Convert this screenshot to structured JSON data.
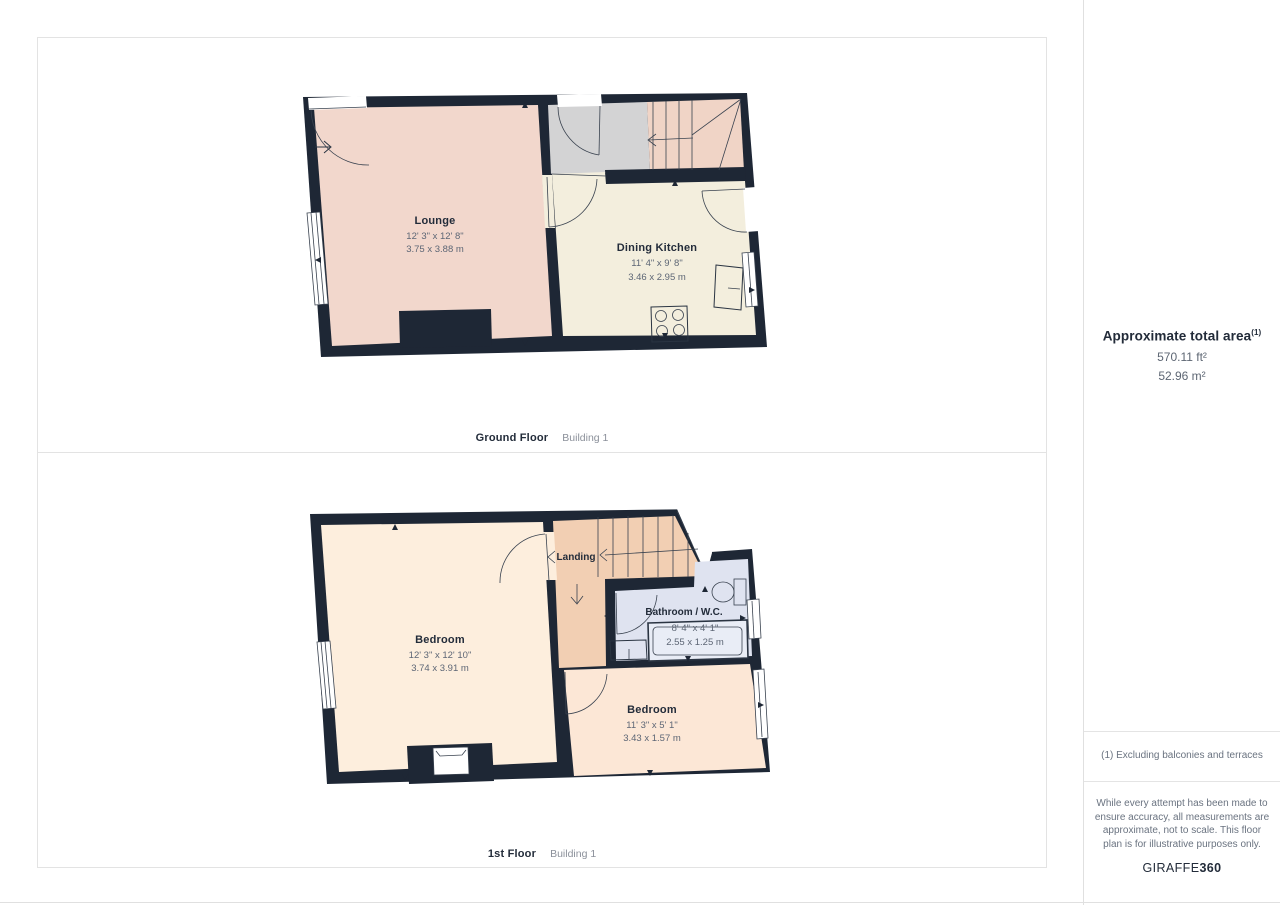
{
  "sidebar": {
    "area_title": "Approximate total area",
    "area_footnote_marker": "(1)",
    "area_imperial": "570.11 ft²",
    "area_metric": "52.96 m²",
    "footnote": "(1) Excluding balconies and terraces",
    "disclaimer": "While every attempt has been made to ensure accuracy, all measurements are approximate, not to scale. This floor plan is for illustrative purposes only.",
    "brand": {
      "name": "GIRAFFE",
      "suffix": "360"
    }
  },
  "floors": [
    {
      "label": "Ground Floor",
      "building": "Building 1",
      "rooms": [
        {
          "name": "Lounge",
          "dimensions_imperial": "12' 3\" x 12' 8\"",
          "dimensions_metric": "3.75 x 3.88 m"
        },
        {
          "name": "Dining Kitchen",
          "dimensions_imperial": "11' 4\" x 9' 8\"",
          "dimensions_metric": "3.46 x 2.95 m"
        }
      ]
    },
    {
      "label": "1st Floor",
      "building": "Building 1",
      "rooms": [
        {
          "name": "Bedroom",
          "dimensions_imperial": "12' 3\" x 12' 10\"",
          "dimensions_metric": "3.74 x 3.91 m"
        },
        {
          "name": "Landing",
          "dimensions_imperial": "",
          "dimensions_metric": ""
        },
        {
          "name": "Bathroom / W.C.",
          "dimensions_imperial": "8' 4\" x 4' 1\"",
          "dimensions_metric": "2.55 x 1.25 m"
        },
        {
          "name": "Bedroom",
          "dimensions_imperial": "11' 3\" x 5' 1\"",
          "dimensions_metric": "3.43 x 1.57 m"
        }
      ]
    }
  ],
  "colors": {
    "wall": "#1e2735",
    "lounge": "#f2d7cc",
    "hall": "#d3d3d4",
    "stairs_ground": "#f0d4c6",
    "dining_kitchen": "#f3eedd",
    "bedroom_main": "#fdeedd",
    "landing": "#f2cfb3",
    "bathroom": "#dfe3f0",
    "bathtub": "#e9edf6",
    "bedroom_second": "#fce7d6",
    "line": "#2a3442",
    "room_label": "#232c3a",
    "dimension_text": "#5d6675",
    "divider": "#e3e3e3"
  }
}
